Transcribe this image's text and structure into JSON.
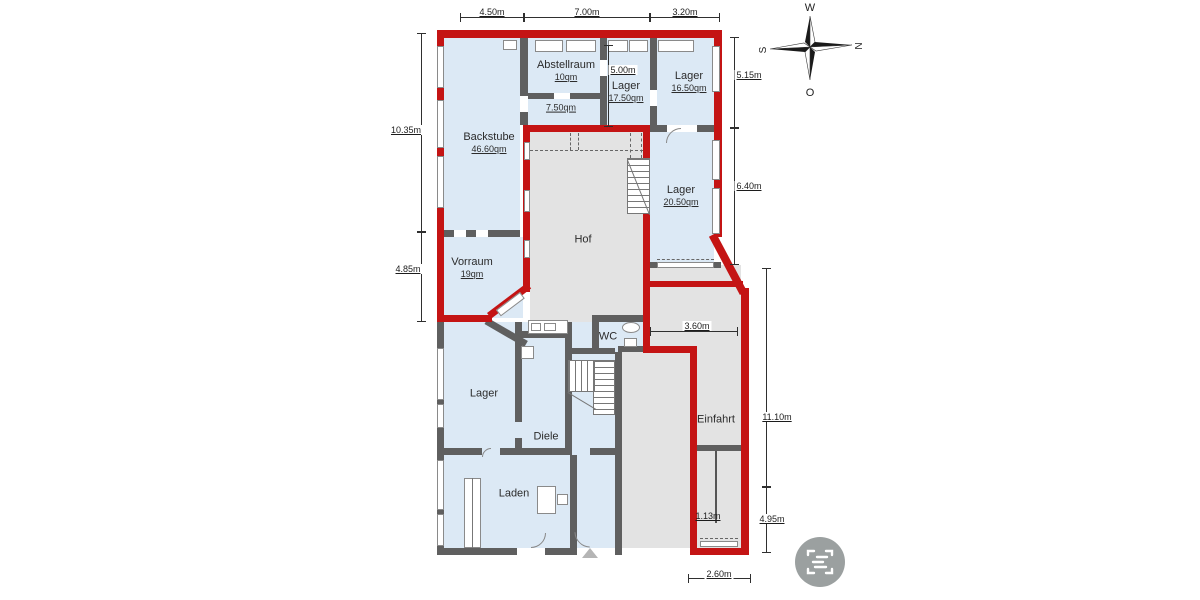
{
  "colors": {
    "outline_red": "#c41414",
    "wall_gray": "#5f5f5f",
    "room_blue": "#dce9f5",
    "court_gray": "#e3e3e3",
    "icon_gray": "#9ba0a0"
  },
  "rooms": {
    "backstube": {
      "label": "Backstube",
      "area": "46.60qm"
    },
    "abstellraum": {
      "label": "Abstellraum",
      "area": "10qm"
    },
    "kammer": {
      "area": "7.50qm"
    },
    "lager_17": {
      "label": "Lager",
      "area": "17.50qm"
    },
    "lager_16": {
      "label": "Lager",
      "area": "16.50qm"
    },
    "lager_20": {
      "label": "Lager",
      "area": "20.50qm"
    },
    "vorraum": {
      "label": "Vorraum",
      "area": "19qm"
    },
    "hof": {
      "label": "Hof"
    },
    "wc": {
      "label": "WC"
    },
    "lager_eg": {
      "label": "Lager"
    },
    "diele": {
      "label": "Diele"
    },
    "laden": {
      "label": "Laden"
    },
    "einfahrt": {
      "label": "Einfahrt"
    }
  },
  "dimensions": {
    "top_left": "4.50m",
    "top_mid": "7.00m",
    "top_right": "3.20m",
    "left_upper": "10.35m",
    "left_lower": "4.85m",
    "right_upper": "5.15m",
    "right_mid": "6.40m",
    "right_lower": "11.10m",
    "right_bottom": "4.95m",
    "inner_vertical": "5.00m",
    "inner_horizontal": "3.60m",
    "inner_small": "1.13m",
    "bottom": "2.60m"
  },
  "compass": {
    "top": "W",
    "right": "N",
    "bottom": "O",
    "left": "S"
  }
}
